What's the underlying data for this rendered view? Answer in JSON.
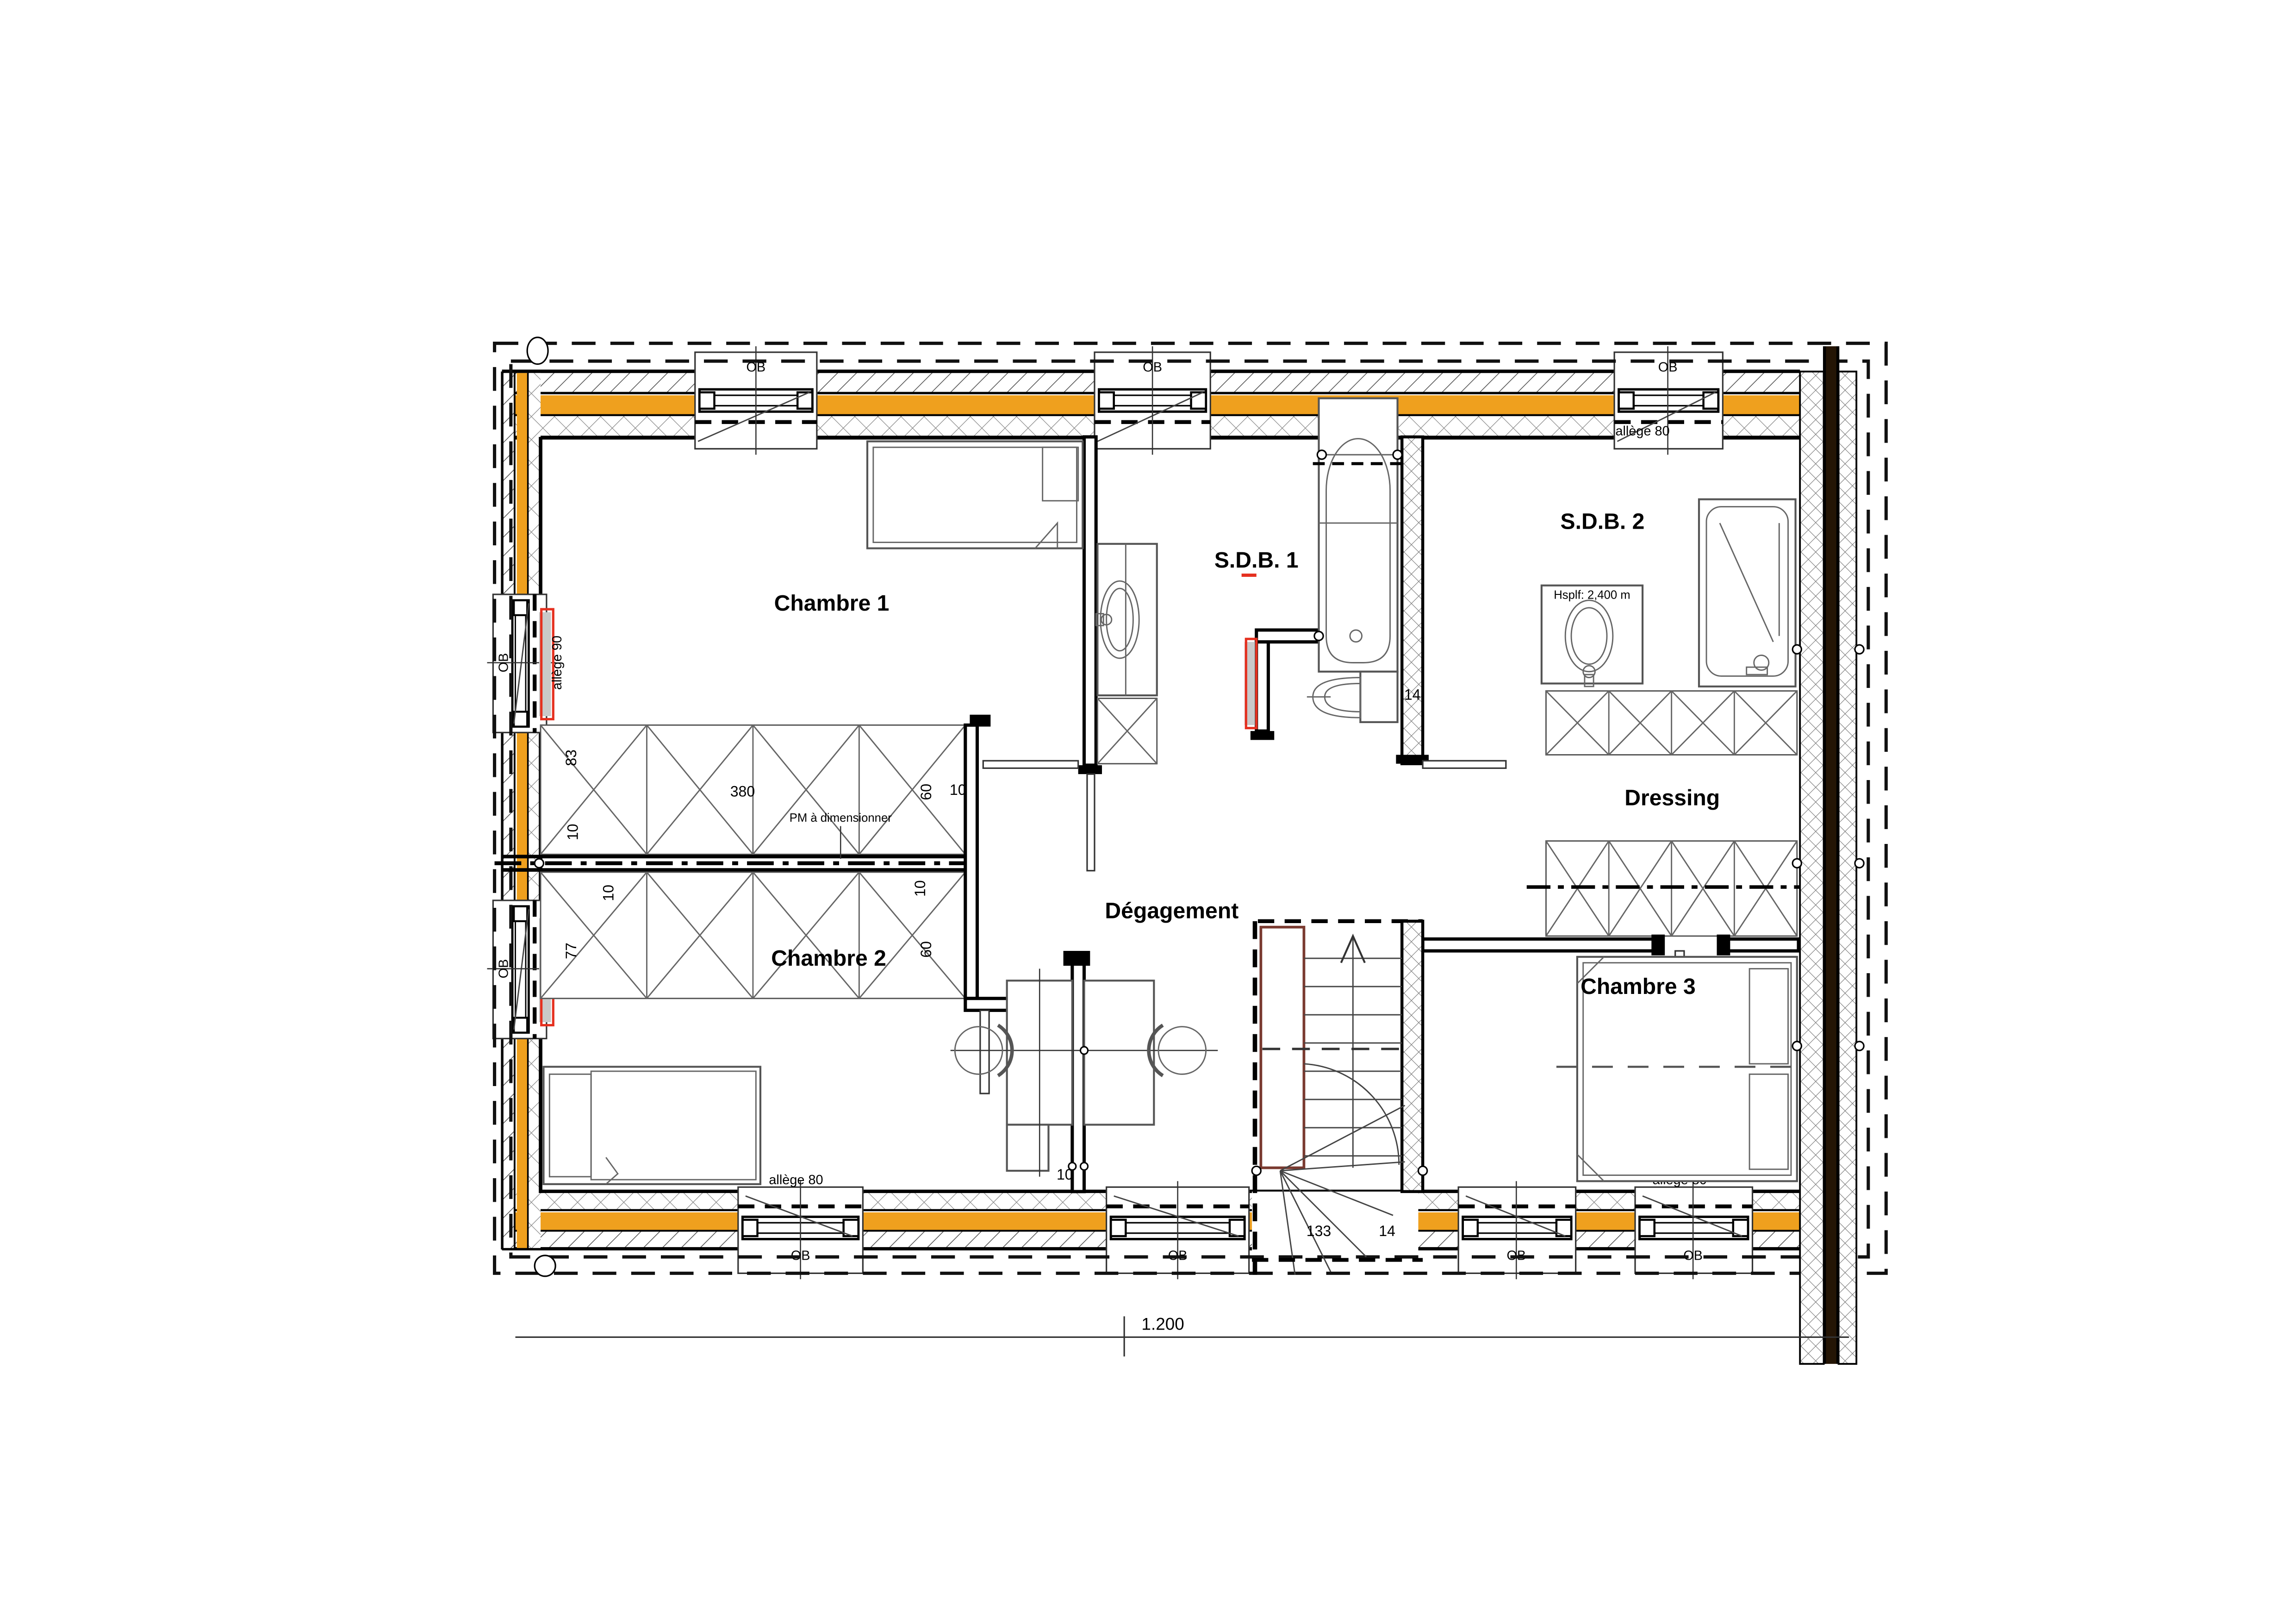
{
  "drawing": {
    "title": "Plan étage - logement",
    "rooms": {
      "chambre1": "Chambre 1",
      "chambre2": "Chambre 2",
      "chambre3": "Chambre 3",
      "sdb1": "S.D.B. 1",
      "sdb2": "S.D.B. 2",
      "dressing": "Dressing",
      "degagement": "Dégagement"
    },
    "window_label": "OB",
    "annotations": {
      "allege80": "allège 80",
      "allege90": "allège 90",
      "hsplf": "Hsplf: 2,400 m",
      "pm": "PM à dimensionner"
    },
    "dimensions": {
      "total_width": "1.200",
      "wardrobe_length": "380",
      "wardrobe_depth_top": "83",
      "wardrobe_depth_bottom": "77",
      "d10": "10",
      "d60": "60",
      "wall_14": "14",
      "stair_width": "133",
      "stair_14": "14"
    },
    "colors": {
      "insulation": "#efa01e",
      "radiator_red": "#e5301f",
      "radiator_gray": "#c9c9c9",
      "stair_stringer": "#7a3a30",
      "party_wall_core": "#241505"
    }
  }
}
